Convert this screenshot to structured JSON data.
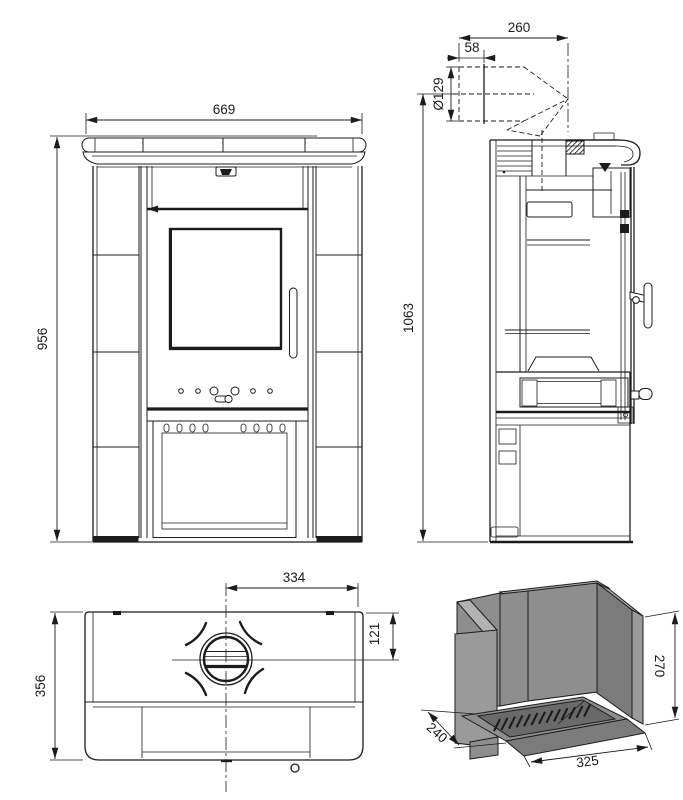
{
  "colors": {
    "line": "#1c1c1c",
    "g1": "#8e8e8e",
    "g2": "#7b7b7b",
    "g3": "#b2b2b2",
    "g4": "#9a9a9a",
    "g5": "#6a6a6a",
    "g6": "#a6a6a6",
    "bg": "#ffffff"
  },
  "views": {
    "front": {
      "dims": {
        "width": "669",
        "height": "956"
      }
    },
    "side": {
      "dims": {
        "rear_offset": "260",
        "small_offset": "58",
        "pipe_diameter": "Ø129",
        "total_height": "1063"
      }
    },
    "top": {
      "dims": {
        "half_width": "334",
        "flue_center": "121",
        "depth": "356"
      }
    },
    "firebox": {
      "dims": {
        "height": "270",
        "depth": "240",
        "width": "325"
      }
    }
  }
}
